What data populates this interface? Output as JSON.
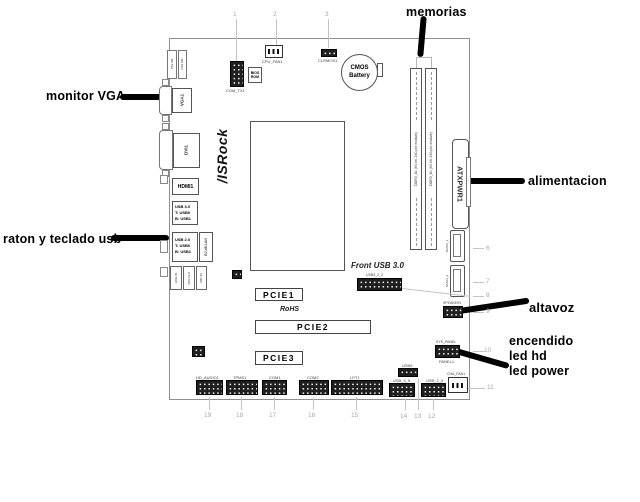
{
  "annotations": {
    "memorias": "memorias",
    "monitor_vga": "monitor VGA",
    "raton_teclado": "raton y teclado usb",
    "alimentacion": "alimentacion",
    "altavoz": "altavoz",
    "encendido": "encendido",
    "led_hd": "led hd",
    "led_power": "led power"
  },
  "callout_numbers": {
    "c1": "1",
    "c2": "2",
    "c3": "3",
    "c6": "6",
    "c7": "7",
    "c8": "8",
    "c9": "9",
    "c10": "10",
    "c11": "11",
    "c12": "12",
    "c13": "13",
    "c14": "14",
    "c15": "15",
    "c16": "16",
    "c17": "17",
    "c18": "18",
    "c19": "19"
  },
  "rear_ports": {
    "ps2_a": "PS2 KB",
    "ps2_b": "PS2 MS",
    "vga": "VGA1",
    "dvi": "DVI1",
    "hdmi": "HDMI1",
    "usb3_lines": [
      "USB 3.0",
      "T: USB0",
      "B: USB1"
    ],
    "usb2_lines": [
      "USB 2.0",
      "T: USB0",
      "B: USB1"
    ],
    "lan": "RJ-45 LAN",
    "audio_jacks": [
      "LINE IN",
      "SPK OUT",
      "MIC IN"
    ]
  },
  "components": {
    "logo": "/ISRock",
    "header1_label": "COM_TX1",
    "bios_rom_lines": [
      "BIOS",
      "ROM"
    ],
    "cpu_fan_label": "CPU_FAN1",
    "clrmos_label": "CLRMOS1",
    "cmos_lines": [
      "CMOS",
      "Battery"
    ],
    "dimm_a_label": "DDR3_A1 (64 bit, 240-pin module)",
    "dimm_b_label": "DDR3_B1 (64 bit, 240-pin module)",
    "atx_power": "ATXPWR1",
    "sata1_label": "SATA3_1",
    "sata2_label": "SATA3_2",
    "front_usb3_title": "Front USB 3.0",
    "front_usb3_label": "USB3_2_3",
    "speaker_label": "SPEAKER1",
    "panel_top_label": "SYS_PANEL",
    "panel_label": "PANEL1",
    "cha_fan_label": "CHA_FAN1",
    "pcie1": "PCIE1",
    "pcie2": "PCIE2",
    "pcie3": "PCIE3",
    "rohs": "RoHS",
    "bottom_labels": [
      "HD_AUDIO1",
      "TPMS1",
      "COM1",
      "COM2",
      "LPT1",
      "USB_4_5",
      "USB6",
      "USB_2_3"
    ]
  },
  "colors": {
    "annotation": "#000000",
    "board_outline": "#8f8f8f",
    "callout": "#a8a8a8"
  }
}
